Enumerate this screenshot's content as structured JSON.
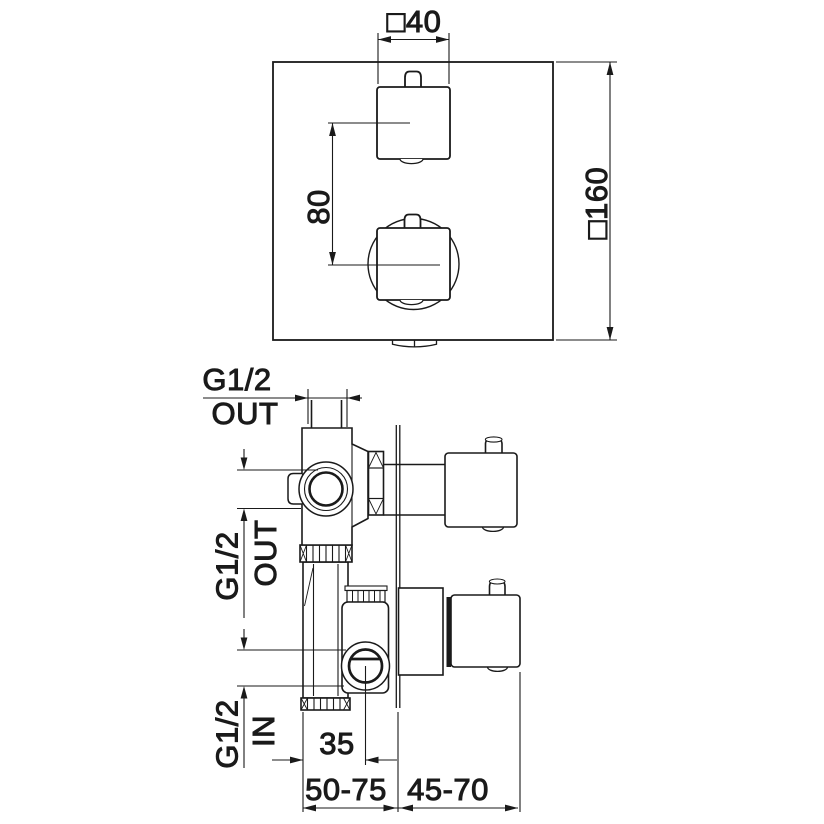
{
  "drawing": {
    "background_color": "#ffffff",
    "line_color": "#1a1a1a",
    "front_view": {
      "handle_width_label": "□40",
      "handle_spacing_label": "80",
      "plate_size_label": "□160"
    },
    "section_view": {
      "top_outlet_thread_label": "G1/2",
      "top_outlet_direction_label": "OUT",
      "side_outlet_thread_label": "G1/2",
      "side_outlet_direction_label": "OUT",
      "inlet_thread_label": "G1/2",
      "inlet_direction_label": "IN",
      "inlet_offset_label": "35",
      "wall_depth_range_label": "50-75",
      "handle_depth_range_label": "45-70"
    }
  }
}
